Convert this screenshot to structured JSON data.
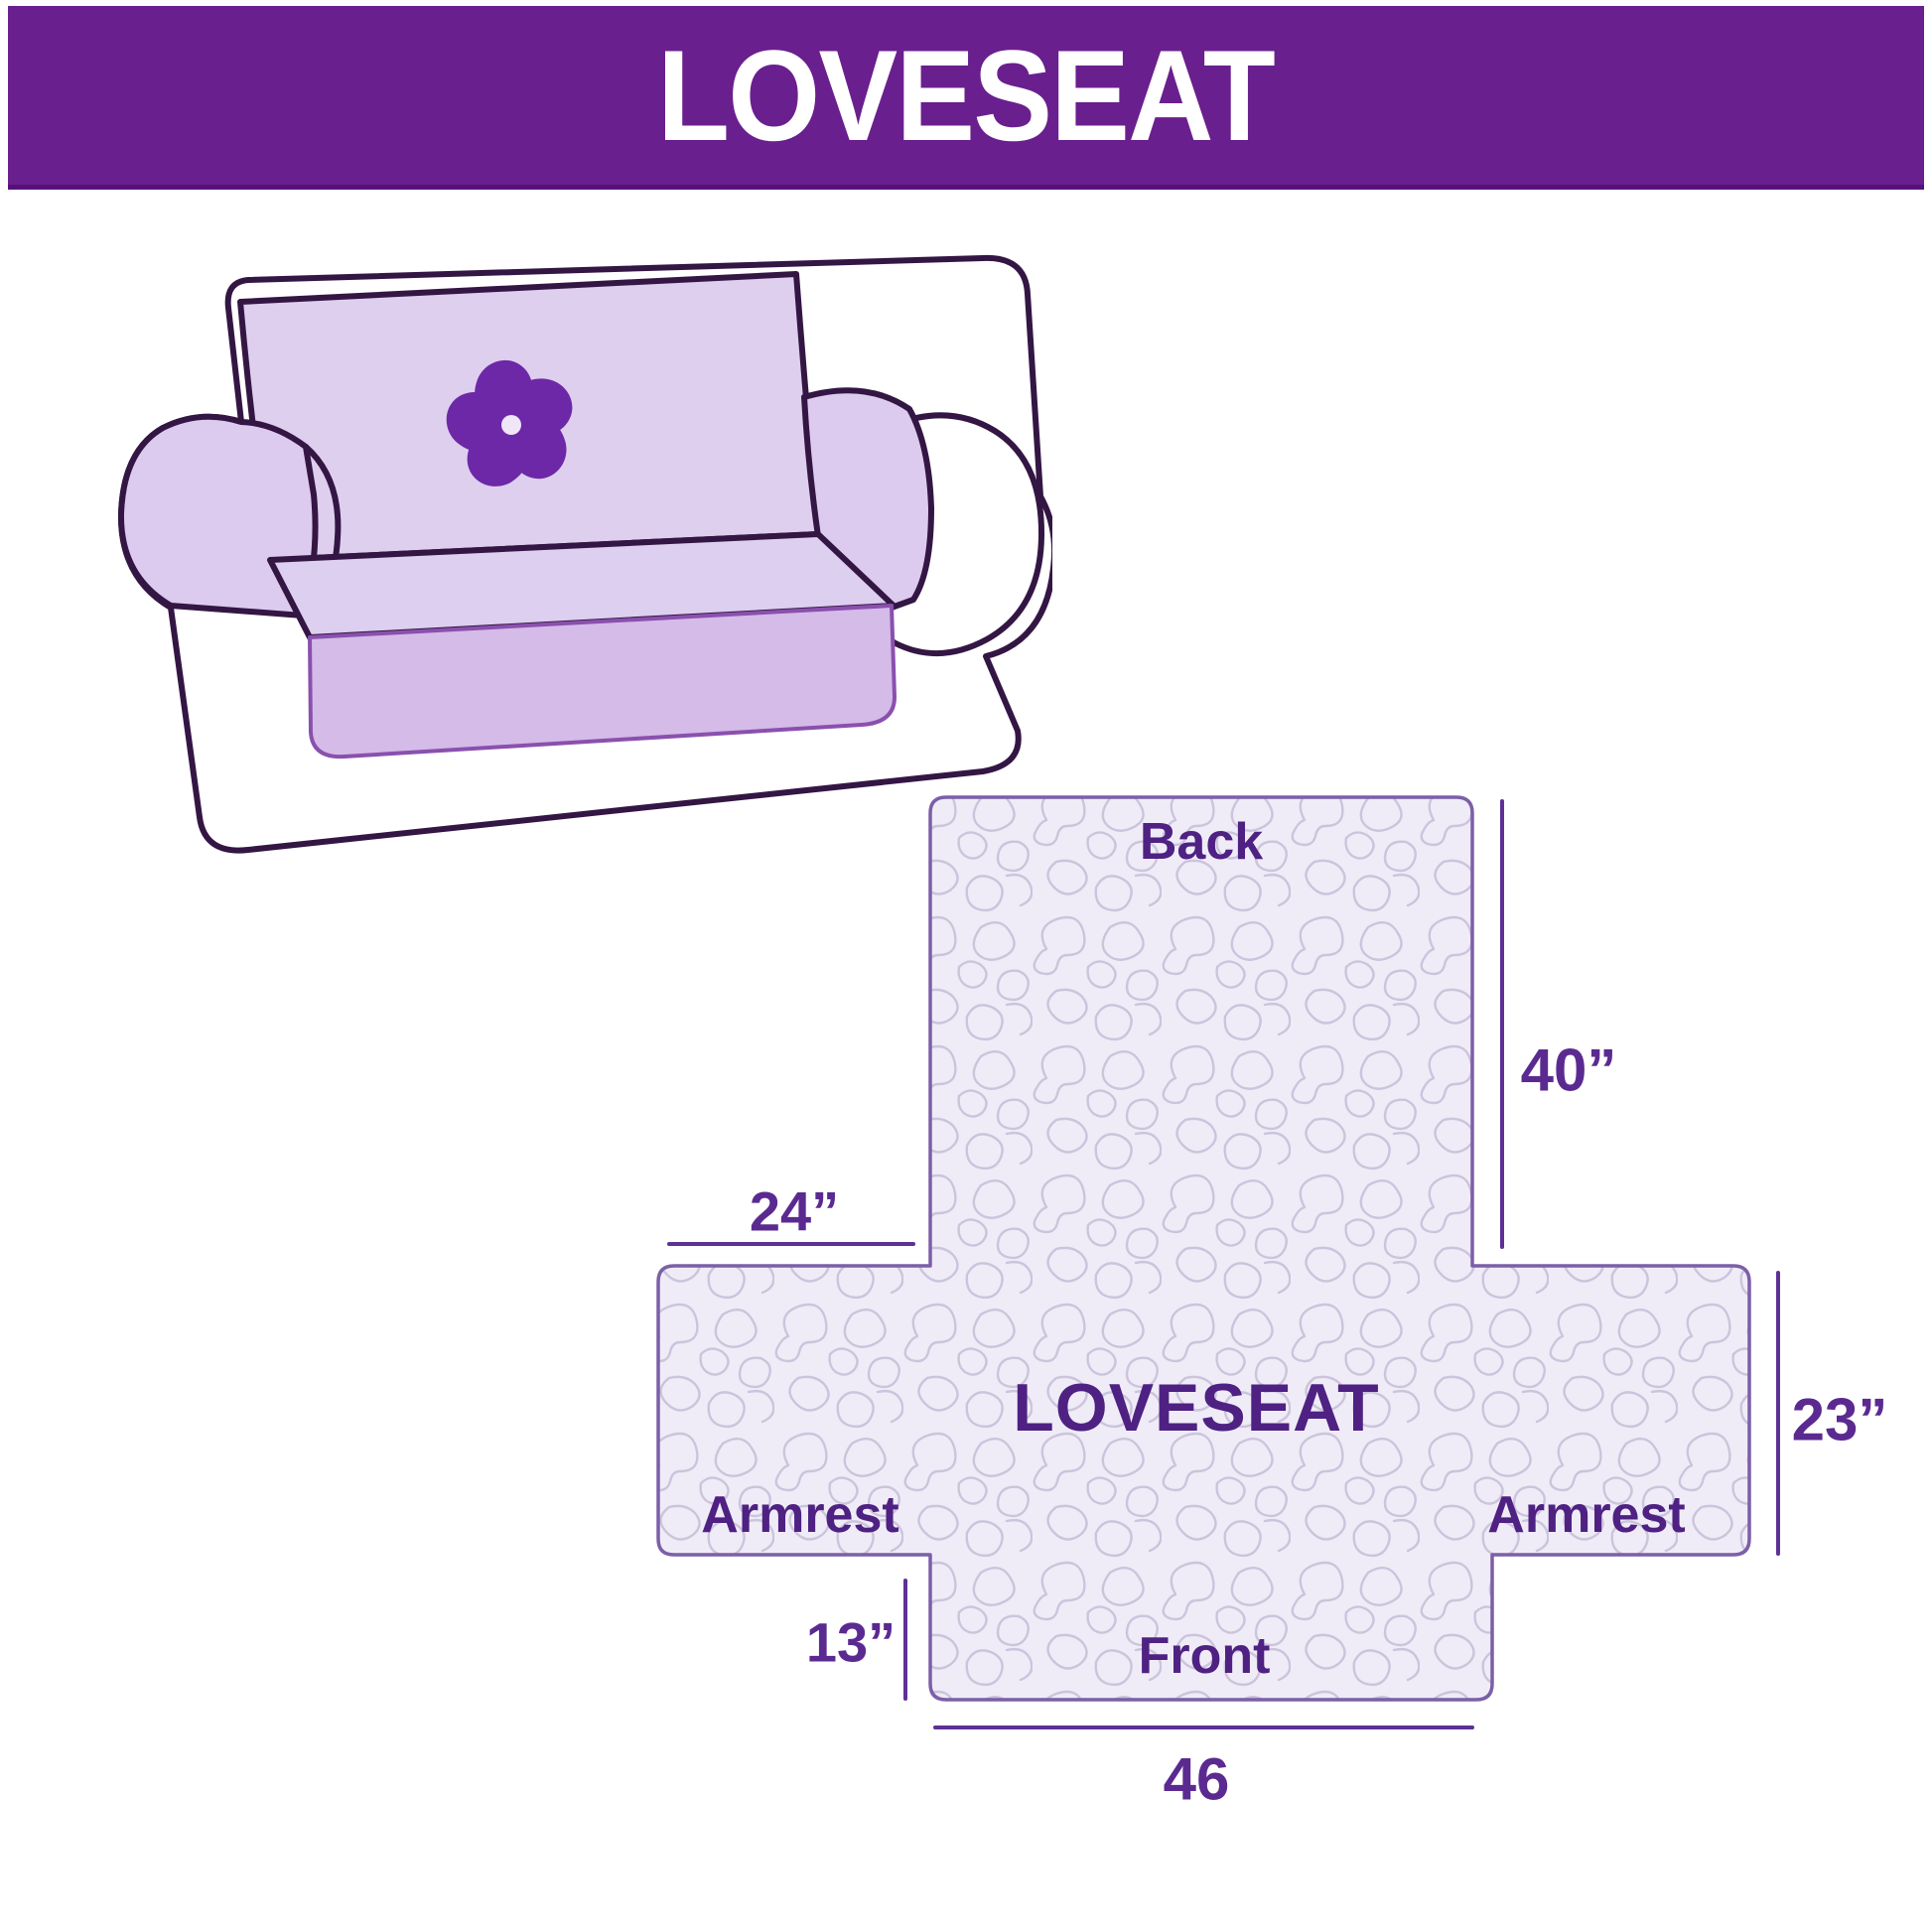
{
  "header": {
    "title": "LOVESEAT"
  },
  "illustration": {
    "description": "loveseat sofa wearing quilted slipcover",
    "logo": "pinwheel-icon"
  },
  "diagram": {
    "product": "LOVESEAT",
    "panel_labels": {
      "back": "Back",
      "front": "Front",
      "armrest_left": "Armrest",
      "armrest_right": "Armrest"
    },
    "dimensions": {
      "back_height": "40”",
      "back_top_width": "24”",
      "side_height": "23”",
      "front_drop": "13”",
      "front_width": "46"
    }
  },
  "colors": {
    "header-bg": "#6a1f8e",
    "title-text": "#ffffff",
    "label-text": "#4e2183",
    "dim-text": "#5b2a91",
    "dim-line": "#5e3194",
    "cover-fill": "#efecf7",
    "pattern-line": "#ccc4dc",
    "cover-border": "#7c5fa8",
    "sofa-outline": "#331643",
    "sofa-cover": "#decfef",
    "sofa-skirt": "#d5bbe8",
    "logo-purple": "#6d28a8"
  }
}
